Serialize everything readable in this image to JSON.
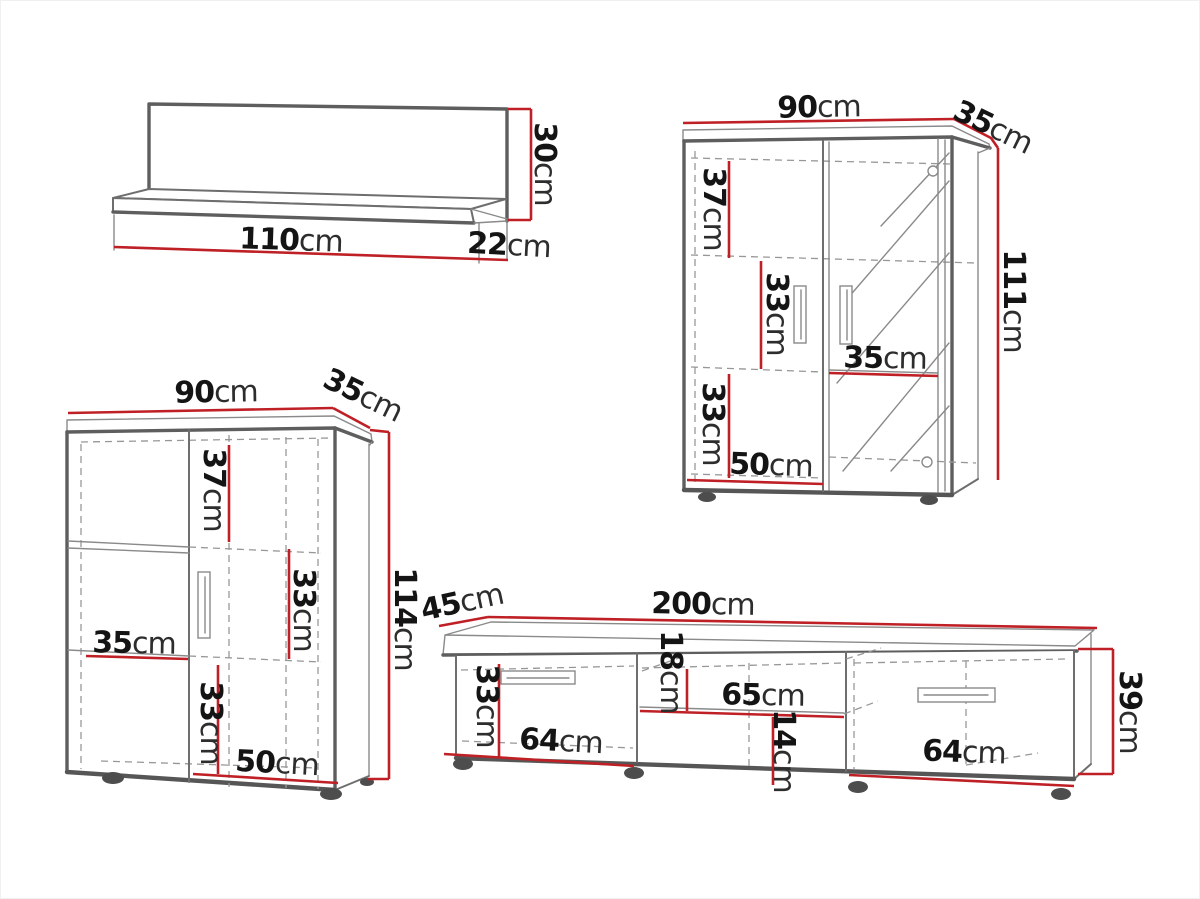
{
  "page": {
    "background": "#ffffff",
    "dimension_line_color": "#bf2026",
    "outline_color": "#5e5e5e",
    "text_color": "#141414"
  },
  "pieces": {
    "wall_shelf": {
      "width": {
        "v": "110",
        "u": "cm"
      },
      "depth": {
        "v": "22",
        "u": "cm"
      },
      "height": {
        "v": "30",
        "u": "cm"
      }
    },
    "display_cabinet": {
      "width": {
        "v": "90",
        "u": "cm"
      },
      "depth": {
        "v": "35",
        "u": "cm"
      },
      "height": {
        "v": "111",
        "u": "cm"
      },
      "top_section": {
        "v": "37",
        "u": "cm"
      },
      "middle_section": {
        "v": "33",
        "u": "cm"
      },
      "shelf_width": {
        "v": "35",
        "u": "cm"
      },
      "bottom_section": {
        "v": "33",
        "u": "cm"
      },
      "left_door_width": {
        "v": "50",
        "u": "cm"
      }
    },
    "highboard": {
      "width": {
        "v": "90",
        "u": "cm"
      },
      "depth": {
        "v": "35",
        "u": "cm"
      },
      "height": {
        "v": "114",
        "u": "cm"
      },
      "top_section": {
        "v": "37",
        "u": "cm"
      },
      "middle_section": {
        "v": "33",
        "u": "cm"
      },
      "shelf_width": {
        "v": "35",
        "u": "cm"
      },
      "bottom_section": {
        "v": "33",
        "u": "cm"
      },
      "bottom_door_width": {
        "v": "50",
        "u": "cm"
      }
    },
    "tv_stand": {
      "width": {
        "v": "200",
        "u": "cm"
      },
      "depth": {
        "v": "45",
        "u": "cm"
      },
      "height": {
        "v": "39",
        "u": "cm"
      },
      "drawer_height": {
        "v": "33",
        "u": "cm"
      },
      "left_drawer_width": {
        "v": "64",
        "u": "cm"
      },
      "niche_height": {
        "v": "18",
        "u": "cm"
      },
      "niche_width": {
        "v": "65",
        "u": "cm"
      },
      "lower_niche_height": {
        "v": "14",
        "u": "cm"
      },
      "right_drawer_width": {
        "v": "64",
        "u": "cm"
      }
    }
  }
}
